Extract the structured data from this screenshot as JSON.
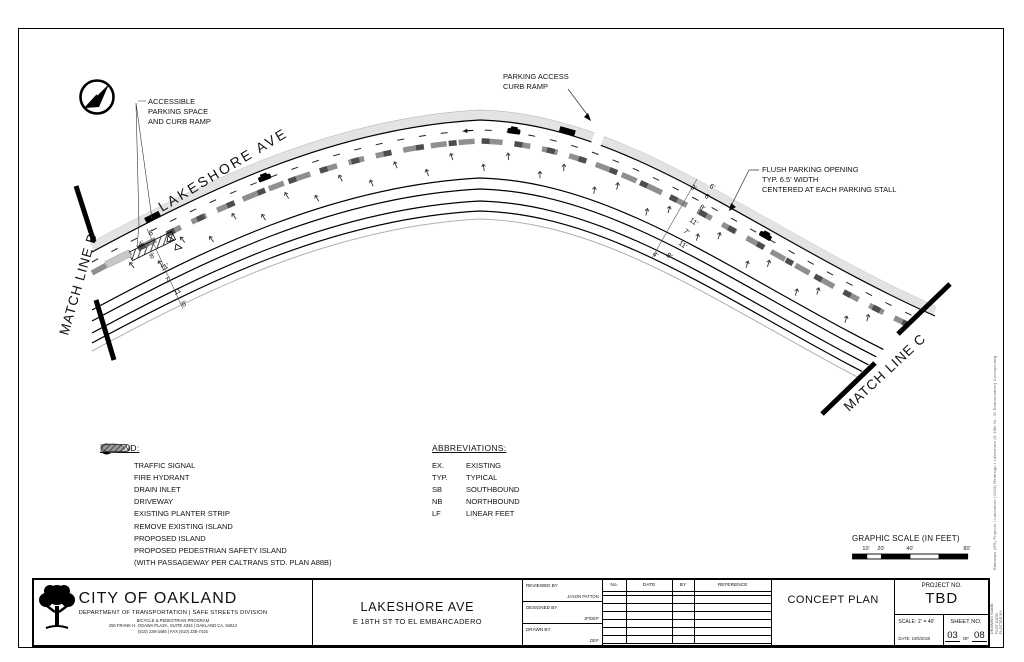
{
  "plan": {
    "street_label": "LAKESHORE AVE",
    "match_line_b": "MATCH LINE B",
    "match_line_c": "MATCH LINE C",
    "callout_accessible": [
      "ACCESSIBLE",
      "PARKING SPACE",
      "AND CURB RAMP"
    ],
    "callout_parking_access": [
      "PARKING ACCESS",
      "CURB RAMP"
    ],
    "callout_flush": [
      "FLUSH PARKING OPENING",
      "TYP. 6.5' WIDTH",
      "CENTERED AT EACH PARKING STALL"
    ],
    "dims_left": [
      "6'",
      "4'",
      "8'",
      "11'",
      "7'",
      "11'",
      "8'"
    ],
    "dims_right": [
      "3'",
      "6'",
      "6'",
      "8'",
      "11'",
      "7'",
      "11'",
      "4'",
      "8'"
    ]
  },
  "legend": {
    "title": "LEGEND:",
    "items": [
      {
        "icon": "traffic-signal-icon",
        "label": "TRAFFIC SIGNAL"
      },
      {
        "icon": "fire-hydrant-icon",
        "label": "FIRE HYDRANT"
      },
      {
        "icon": "drain-inlet-icon",
        "label": "DRAIN INLET"
      },
      {
        "icon": "driveway-icon",
        "label": "DRIVEWAY"
      },
      {
        "icon": "planter-strip-icon",
        "label": "EXISTING PLANTER STRIP"
      },
      {
        "icon": "remove-island-icon",
        "label": "REMOVE EXISTING ISLAND"
      },
      {
        "icon": "proposed-island-icon",
        "label": "PROPOSED ISLAND"
      },
      {
        "icon": "ped-safety-island-icon",
        "label": "PROPOSED PEDESTRIAN SAFETY ISLAND",
        "note": "(WITH PASSAGEWAY PER CALTRANS STD. PLAN A88B)"
      }
    ],
    "traffic_signal_letters": "TS"
  },
  "abbreviations": {
    "title": "ABBREVIATIONS:",
    "items": [
      {
        "abbr": "EX.",
        "term": "EXISTING"
      },
      {
        "abbr": "TYP.",
        "term": "TYPICAL"
      },
      {
        "abbr": "SB",
        "term": "SOUTHBOUND"
      },
      {
        "abbr": "NB",
        "term": "NORTHBOUND"
      },
      {
        "abbr": "LF",
        "term": "LINEAR FEET"
      }
    ]
  },
  "graphic_scale": {
    "label": "GRAPHIC SCALE (IN FEET)",
    "ticks": [
      "10'",
      "20'",
      "40'",
      "80'"
    ]
  },
  "title_block": {
    "agency": "CITY OF OAKLAND",
    "department": "DEPARTMENT OF TRANSPORTATION | SAFE STREETS DIVISION",
    "program": "BICYCLE & PEDESTRIAN PROGRAM",
    "address": "250 FRANK H. OGAWA PLAZA, SUITE 4344 | OAKLAND CA, 94612",
    "phone": "(510) 238-3466 | FAX (510) 238-7415",
    "project_title": "LAKESHORE AVE",
    "project_subtitle": "E 18TH ST TO EL EMBARCADERO",
    "reviewed_by_label": "REVIEWED BY",
    "reviewed_by": "JASON PATTON",
    "designed_by_label": "DESIGNED BY",
    "designed_by": "JP/DEP",
    "drawn_by_label": "DRAWN BY",
    "drawn_by": "DEP",
    "revision_headers": [
      "No.",
      "DATE",
      "BY",
      "REFERENCE"
    ],
    "plan_type": "CONCEPT PLAN",
    "project_no_label": "PROJECT NO.",
    "project_no": "TBD",
    "scale_label": "SCALE:",
    "scale_value": "1\" = 40'",
    "date_label": "DATE:",
    "date_value": "10/5/2020",
    "sheet_no_label": "SHEET NO.",
    "sheet_no": "03",
    "of_label": "OF",
    "sheet_total": "08"
  },
  "margin": {
    "file_text": "Bikeways (DR) Projects / Lakeshore (2020) Redesign / Lakeshore (E 18th St - El Embarcadero) Concept.dwg",
    "stamp_lines": [
      "DRAWING NAME:",
      "PLOT DATE:",
      "PLOTTED BY:"
    ]
  }
}
